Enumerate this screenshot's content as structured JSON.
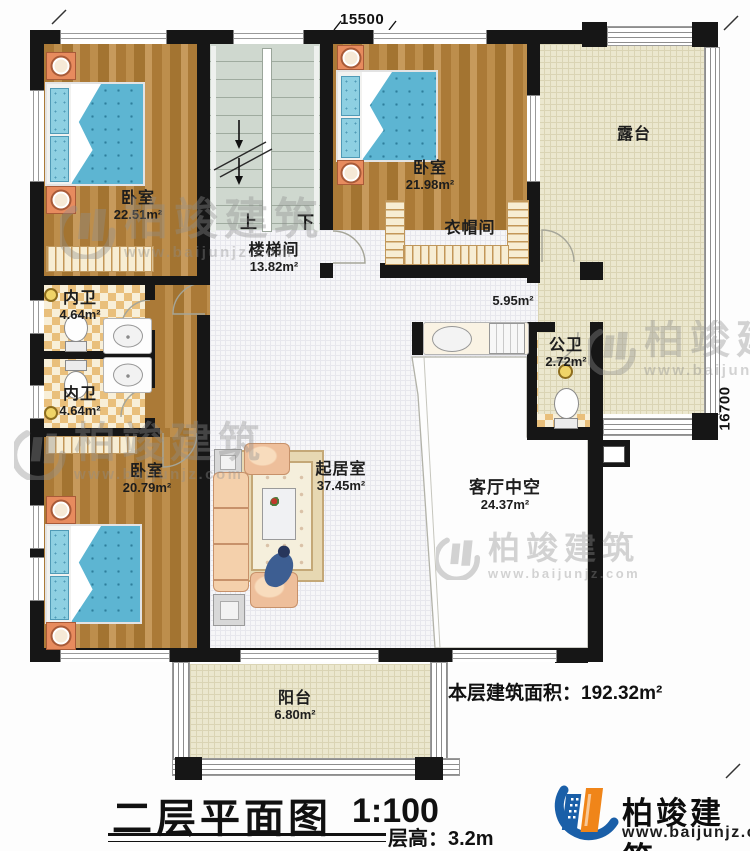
{
  "plan": {
    "dimension_top": "15500",
    "dimension_right": "16700",
    "stairs": {
      "up": "上",
      "down": "下"
    },
    "rooms": [
      {
        "id": "bedroom-top-left",
        "name": "卧室",
        "area": "22.51m²"
      },
      {
        "id": "stairwell",
        "name": "楼梯间",
        "area": "13.82m²"
      },
      {
        "id": "bedroom-top-middle",
        "name": "卧室",
        "area": "21.98m²"
      },
      {
        "id": "cloakroom",
        "name": "衣帽间",
        "area": ""
      },
      {
        "id": "terrace",
        "name": "露台",
        "area": ""
      },
      {
        "id": "inner-bath-1",
        "name": "内卫",
        "area": "4.64m²"
      },
      {
        "id": "inner-bath-2",
        "name": "内卫",
        "area": "4.64m²"
      },
      {
        "id": "hallway",
        "name": "",
        "area": "5.95m²"
      },
      {
        "id": "public-bath",
        "name": "公卫",
        "area": "2.72m²"
      },
      {
        "id": "bedroom-bottom-left",
        "name": "卧室",
        "area": "20.79m²"
      },
      {
        "id": "living-room",
        "name": "起居室",
        "area": "37.45m²"
      },
      {
        "id": "living-void",
        "name": "客厅中空",
        "area": "24.37m²"
      },
      {
        "id": "balcony",
        "name": "阳台",
        "area": "6.80m²"
      }
    ]
  },
  "watermark": {
    "brand": "柏竣建筑",
    "url": "www.baijunjz.com"
  },
  "footer": {
    "floor_area_label": "本层建筑面积：",
    "floor_area_value": "192.32m²",
    "title": "二层平面图",
    "scale": "1:100",
    "floor_height": "层高：3.2m",
    "brand": "柏竣建筑",
    "website": "www.baijunjz.com"
  },
  "colors": {
    "wall": "#161616",
    "wood": "#b5834a",
    "bed": "#5db5d2",
    "terrace": "#ebe7ce",
    "checker": "#e9bf7b",
    "brand_blue": "#1a5fa8",
    "brand_orange": "#f08519"
  }
}
